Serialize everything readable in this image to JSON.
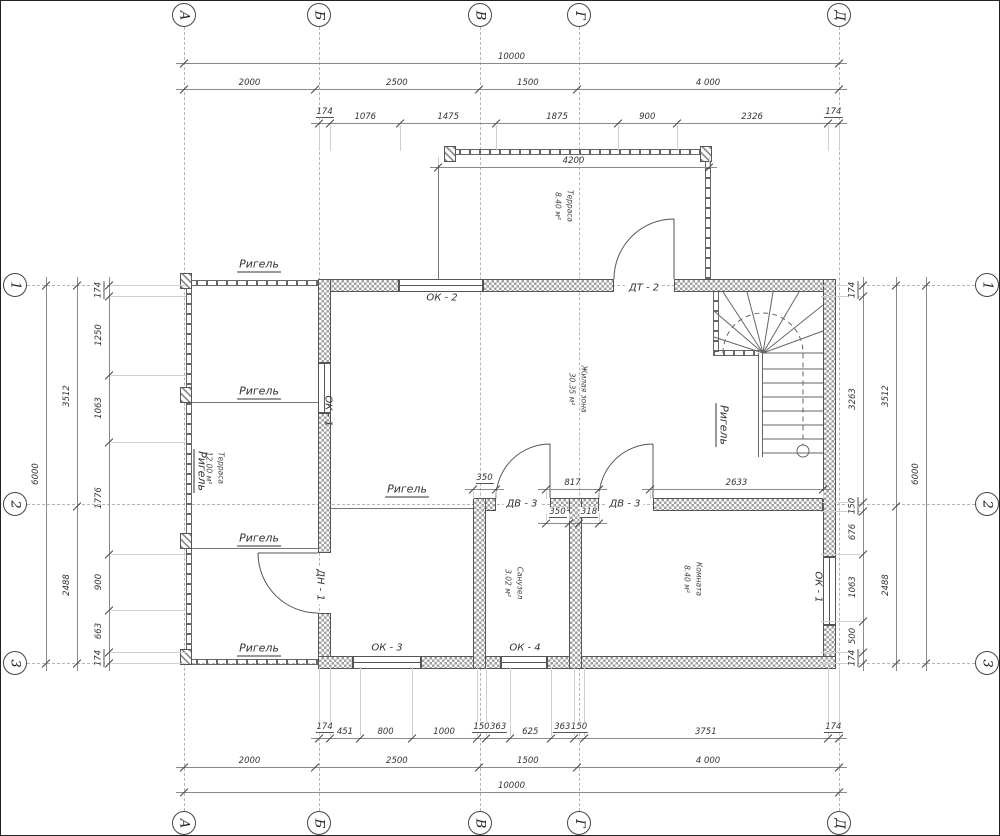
{
  "title": "Поэтажный план (1 этаж)",
  "axis": {
    "cols": [
      "А",
      "Б",
      "В",
      "Г",
      "Д"
    ],
    "rows": [
      "1",
      "2",
      "3"
    ]
  },
  "dims": {
    "total": [
      "10000"
    ],
    "axes_spacing": [
      "2000",
      "2500",
      "1500",
      "4 000"
    ],
    "top_detail": [
      "174",
      "1076",
      "1475",
      "1875",
      "900",
      "2326",
      "174"
    ],
    "terrace_width": [
      "4200"
    ],
    "mid_upper": [
      "350",
      "817",
      "2633"
    ],
    "mid_lower": [
      "350",
      "318"
    ],
    "bottom_detail": [
      "174",
      "451",
      "800",
      "1000",
      "150",
      "363",
      "625",
      "363",
      "150",
      "3751",
      "174"
    ],
    "side_outer": [
      "6000"
    ],
    "side_mid": [
      "3512",
      "2488"
    ],
    "left_detail": [
      "174",
      "1250",
      "1063",
      "1776",
      "900",
      "663",
      "174"
    ],
    "right_detail": [
      "174",
      "3263",
      "150",
      "676",
      "1063",
      "500",
      "174"
    ]
  },
  "beam_label": "Ригель",
  "windows": {
    "ok1": "ОК - 1",
    "ok2": "ОК - 2",
    "ok3": "ОК - 3",
    "ok4": "ОК - 4"
  },
  "doors": {
    "dn1": "ДН - 1",
    "dt2": "ДТ - 2",
    "dv3": "ДВ - 3"
  },
  "rooms": {
    "terrace_top": {
      "name": "Терраса",
      "area": "8.40 м²"
    },
    "terrace_left": {
      "name": "Терраса",
      "area": "12.00 м²"
    },
    "living": {
      "name": "Жилая зона",
      "area": "30.35 м²"
    },
    "bathroom": {
      "name": "Санузел",
      "area": "3.02 м²"
    },
    "bedroom": {
      "name": "Комната",
      "area": "8.40 м²"
    }
  }
}
